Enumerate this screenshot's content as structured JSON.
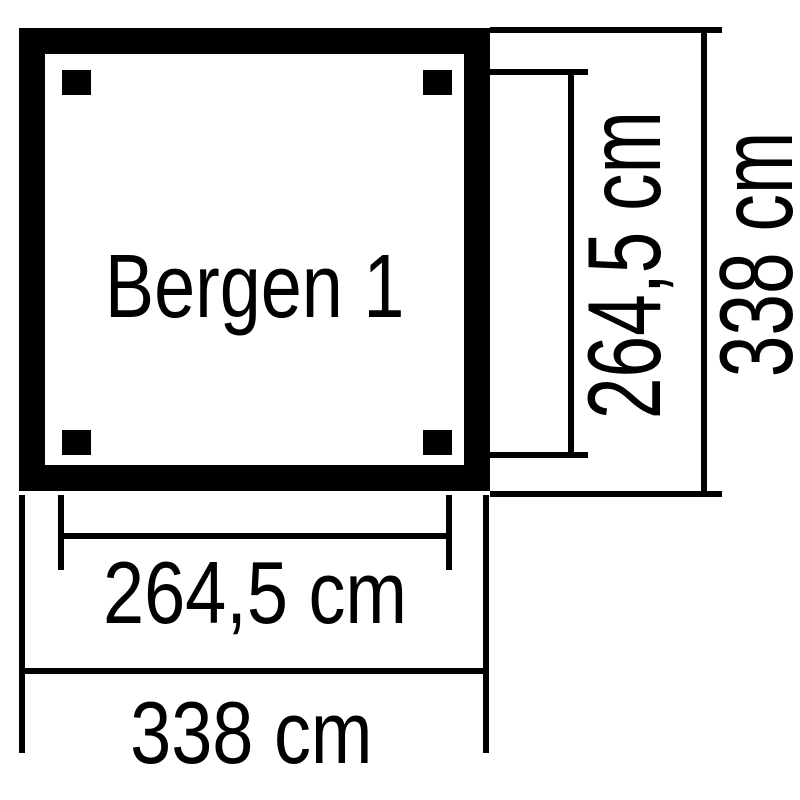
{
  "diagram": {
    "title": "Bergen 1",
    "colors": {
      "line": "#000000",
      "background": "#ffffff"
    },
    "dimension_labels": {
      "vertical_inner": "264,5 cm",
      "vertical_outer": "338 cm",
      "horizontal_inner": "264,5 cm",
      "horizontal_outer": "338 cm"
    }
  }
}
